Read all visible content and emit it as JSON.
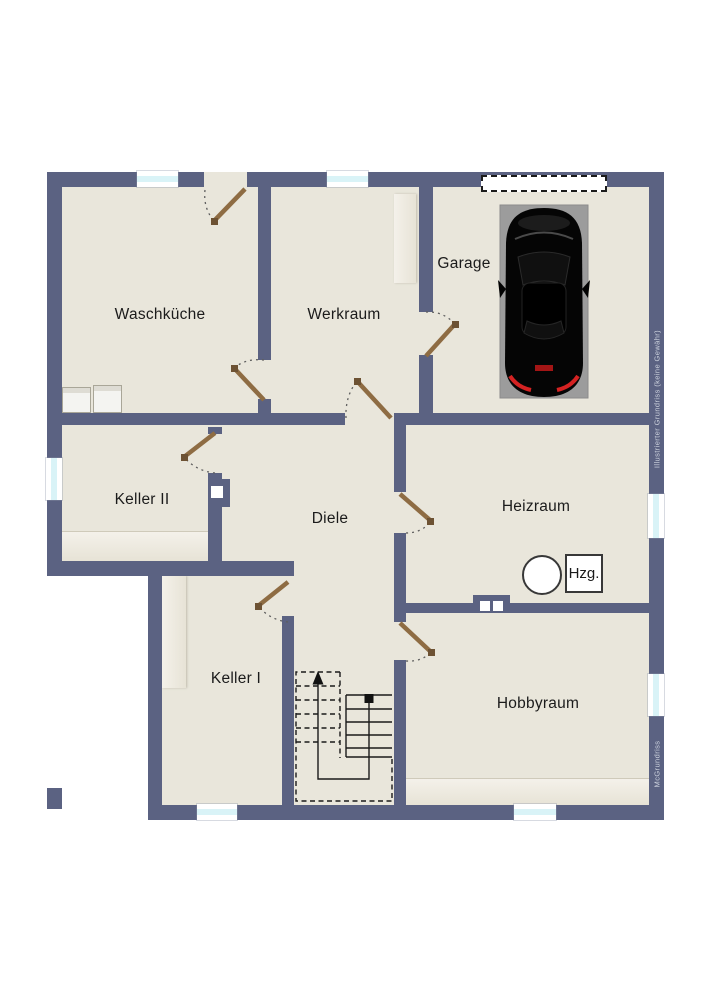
{
  "floorplan": {
    "type": "basement-floor-plan",
    "rooms": [
      {
        "id": "waschkueche",
        "label": "Waschküche"
      },
      {
        "id": "werkraum",
        "label": "Werkraum"
      },
      {
        "id": "garage",
        "label": "Garage"
      },
      {
        "id": "keller2",
        "label": "Keller II"
      },
      {
        "id": "diele",
        "label": "Diele"
      },
      {
        "id": "heizraum",
        "label": "Heizraum"
      },
      {
        "id": "keller1",
        "label": "Keller I"
      },
      {
        "id": "hobbyraum",
        "label": "Hobbyraum"
      }
    ],
    "equipment": {
      "heater_box_label": "Hzg."
    },
    "fixtures": [
      "car-top-view",
      "washing-machine",
      "washing-machine",
      "heating-tank-circle",
      "staircase",
      "garage-door",
      "chimney-vents"
    ],
    "watermarks": {
      "right_margin": "Illustrierter Grundriss (keine Gewähr)",
      "bottom_right": "McGrundriss"
    },
    "colors": {
      "wall": "#5b6282",
      "floor": "#e9e6db",
      "counter": "#f2efe6",
      "window_glass": "#d9f3f7",
      "door_leaf": "#8e6c43",
      "car_pad": "#9c9c9c",
      "background": "#ffffff"
    }
  }
}
